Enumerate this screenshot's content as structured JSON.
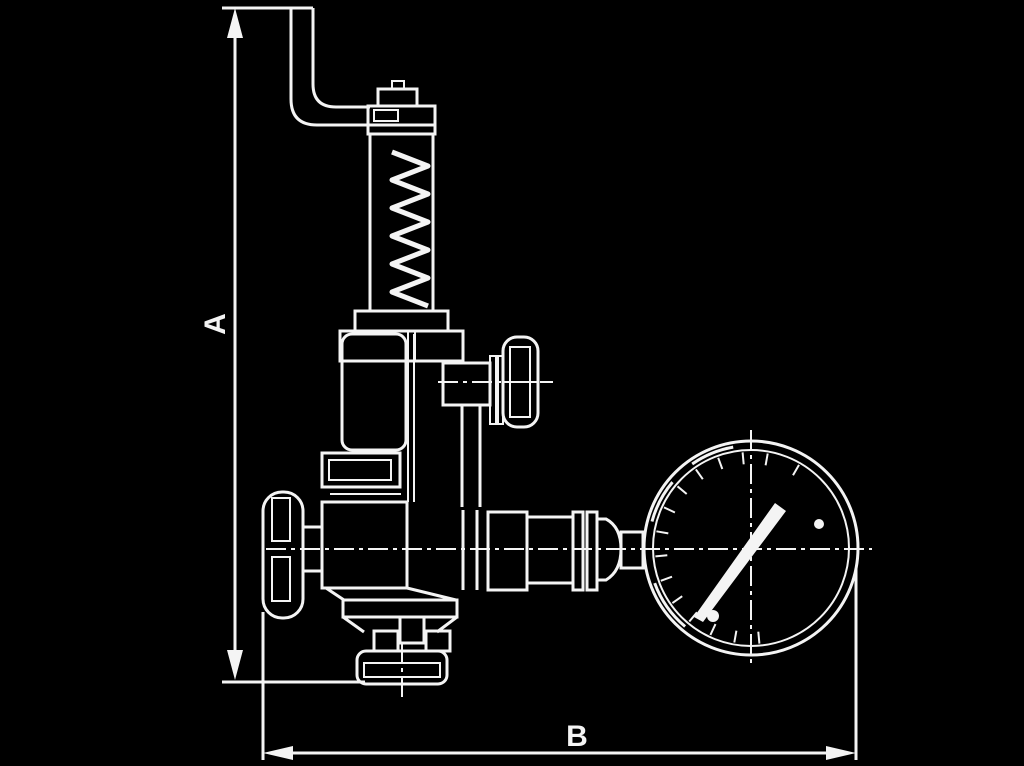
{
  "colors": {
    "background": "#000000",
    "ink": "#f4f4f4"
  },
  "labels": {
    "dimension_vertical": "A",
    "dimension_horizontal": "B"
  }
}
